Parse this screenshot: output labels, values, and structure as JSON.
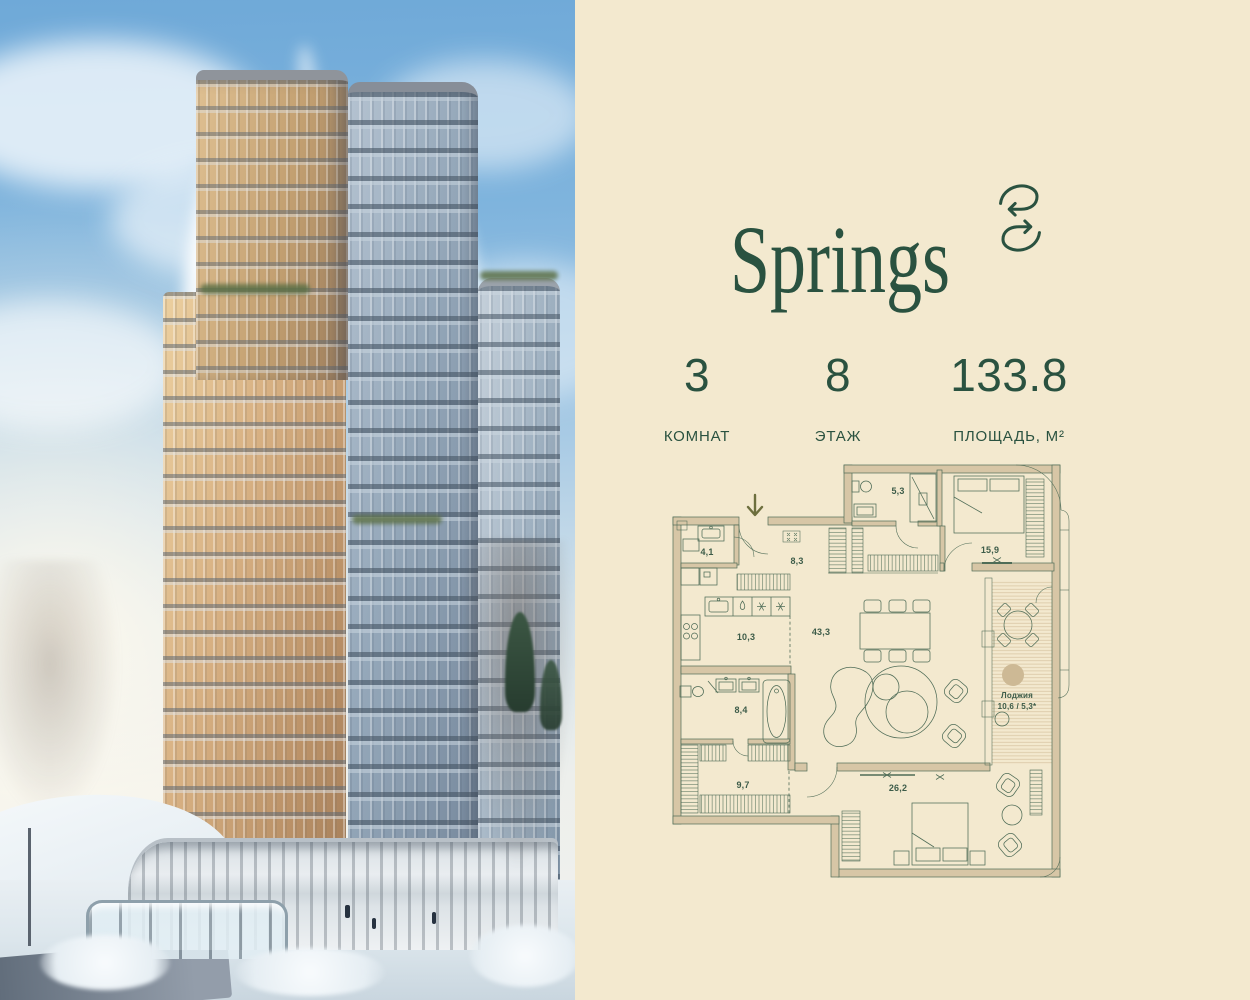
{
  "brand": {
    "name": "Springs"
  },
  "colors": {
    "background": "#f3e9cf",
    "brand_green": "#2a5240",
    "plan_line": "#4f6c57",
    "plan_wall_fill": "#d7c6a6",
    "entry_arrow_olive": "#6d6f3e"
  },
  "stats": {
    "items": [
      {
        "value": "3",
        "label": "КОМНАТ"
      },
      {
        "value": "8",
        "label": "ЭТАЖ"
      },
      {
        "value": "133.8",
        "label": "ПЛОЩАДЬ, М²"
      }
    ]
  },
  "floor_plan": {
    "rooms": [
      {
        "name": "wc",
        "area": "4,1"
      },
      {
        "name": "hallway",
        "area": "8,3"
      },
      {
        "name": "bathroom-small",
        "area": "5,3"
      },
      {
        "name": "bedroom-primary",
        "area": "15,9"
      },
      {
        "name": "kitchen",
        "area": "10,3"
      },
      {
        "name": "living-dining",
        "area": "43,3"
      },
      {
        "name": "bathroom-main",
        "area": "8,4"
      },
      {
        "name": "wardrobe-room",
        "area": "9,7"
      },
      {
        "name": "bedroom-second",
        "area": "26,2"
      }
    ],
    "loggia": {
      "name": "Лоджия",
      "area": "10,6 / 5,3*"
    }
  }
}
